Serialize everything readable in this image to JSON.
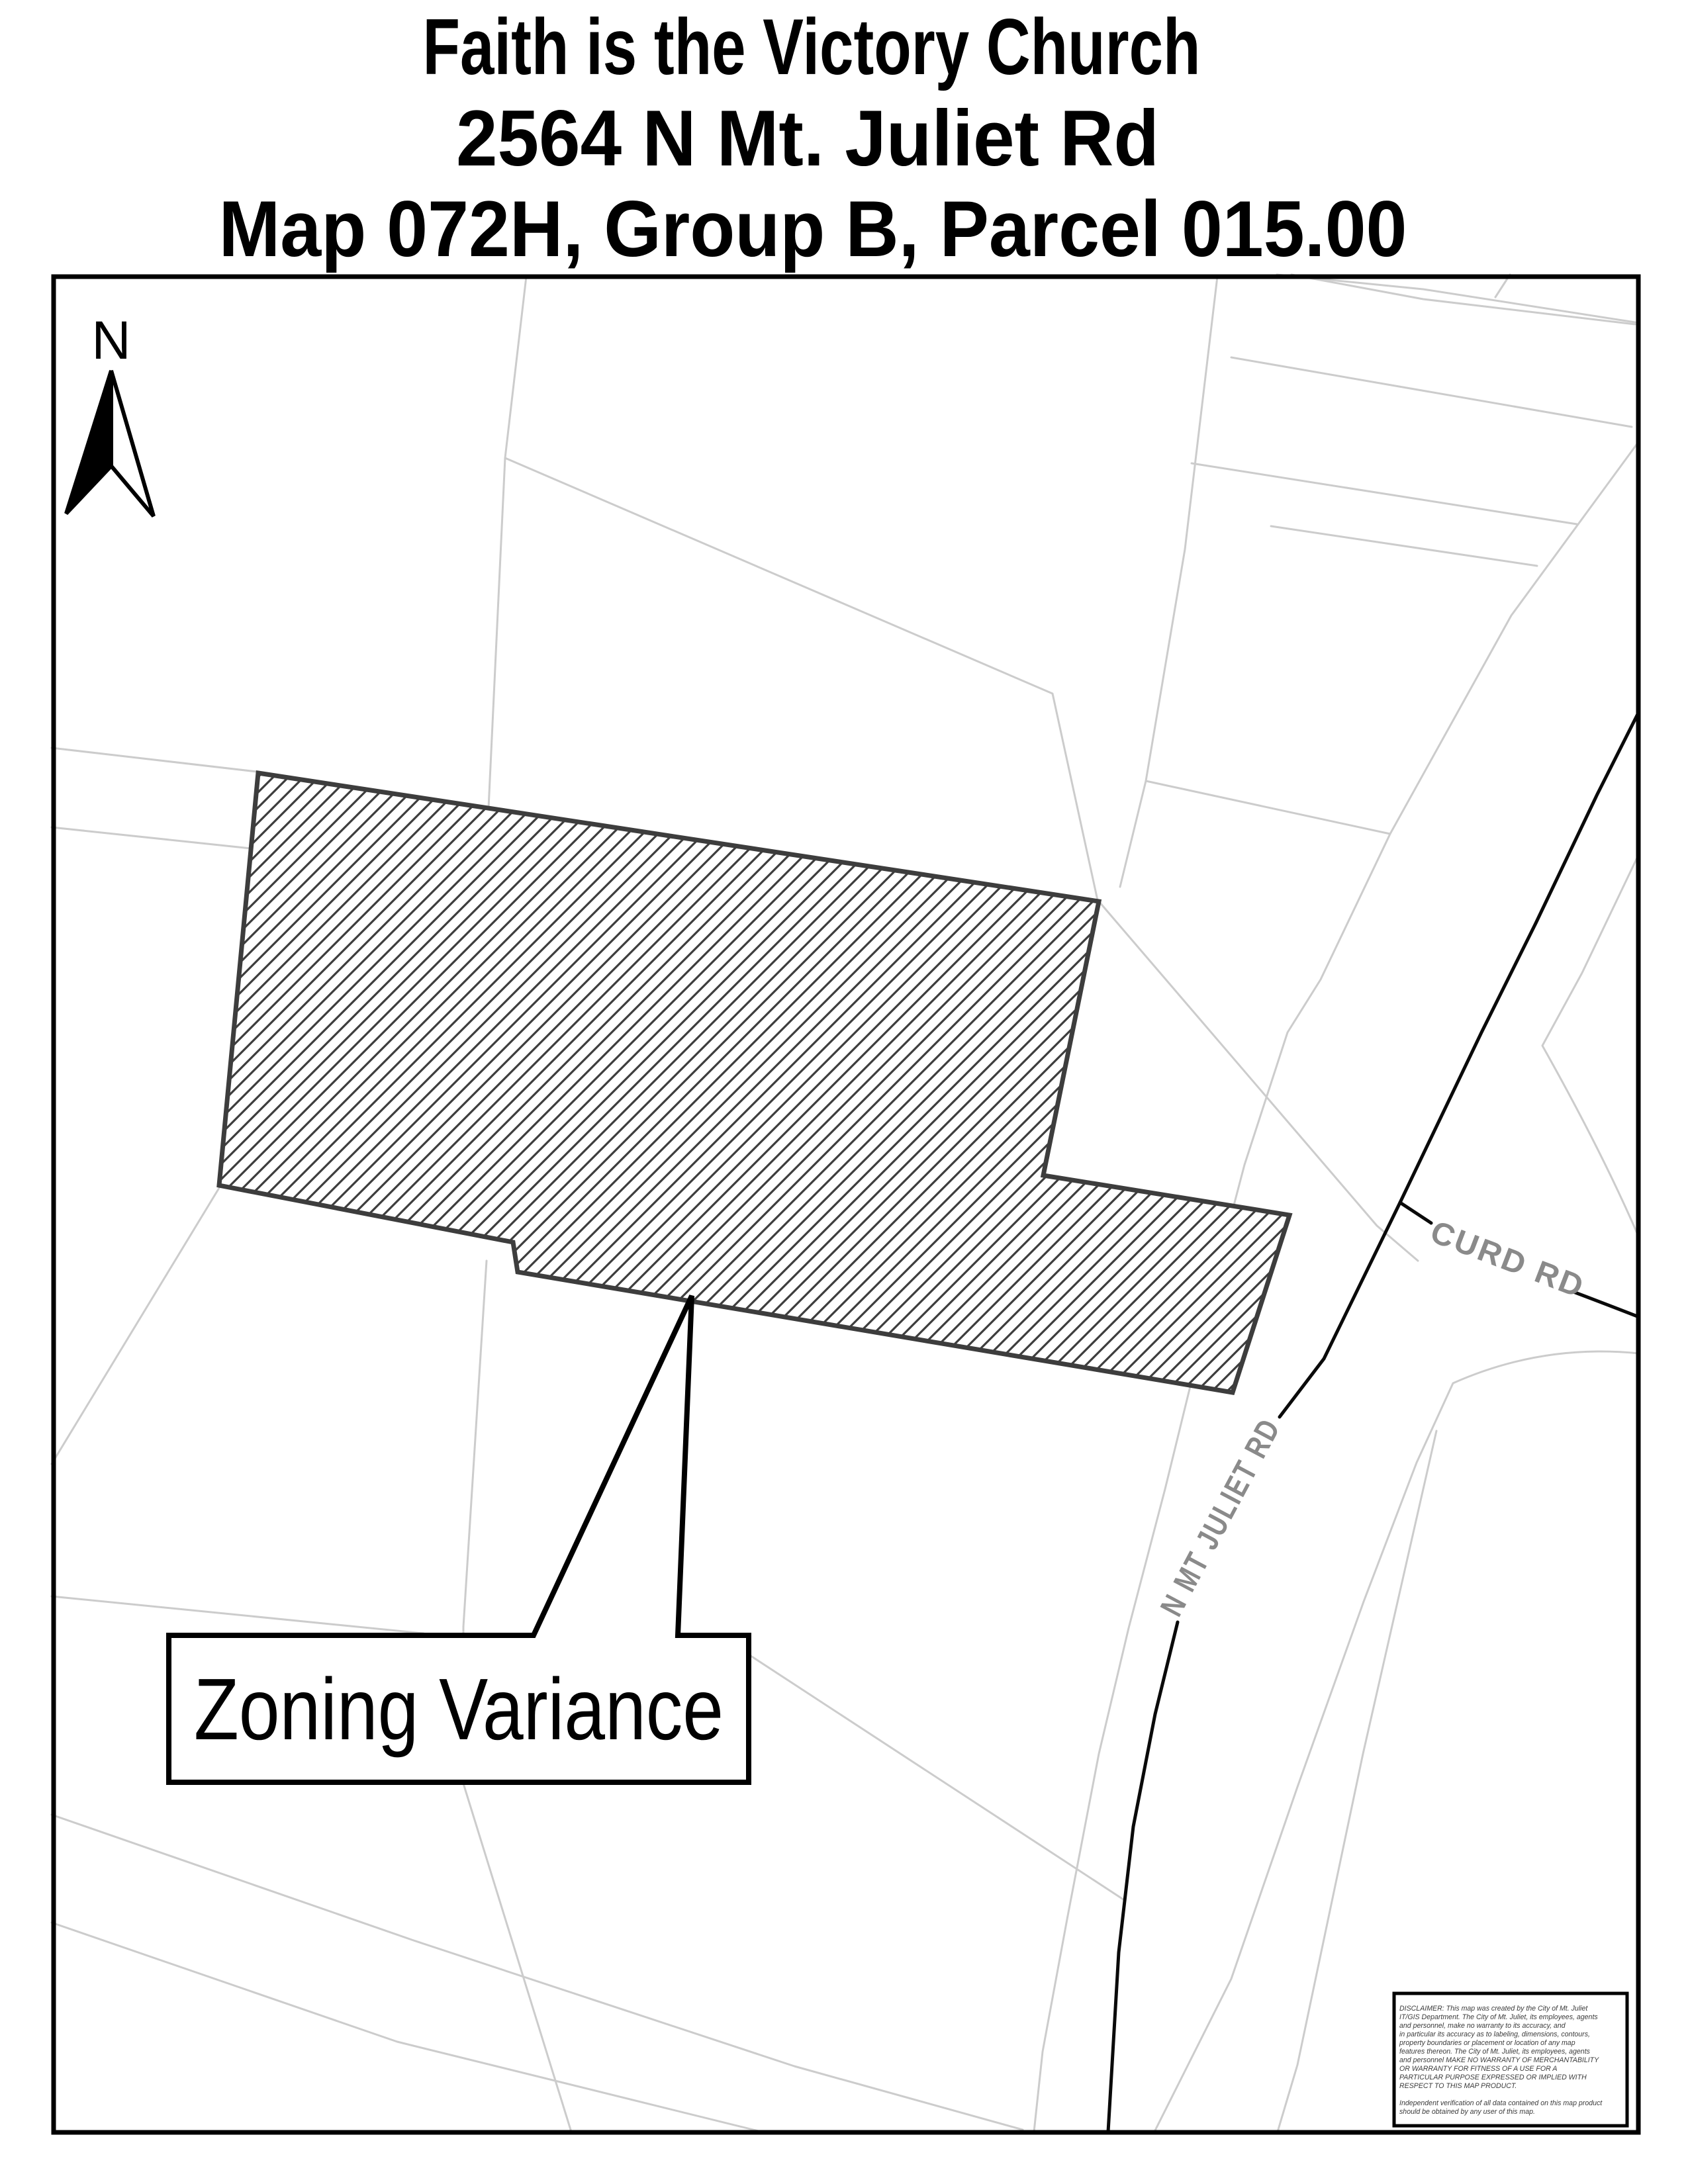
{
  "title": {
    "line1": "Faith is the Victory Church",
    "line2": "2564 N Mt. Juliet Rd",
    "line3": "Map 072H, Group B, Parcel 015.00"
  },
  "map": {
    "north_label": "N",
    "roads": {
      "curd": "CURD RD",
      "n_mt_juliet": "N MT JULIET RD"
    },
    "callout": {
      "label": "Zoning Variance"
    },
    "disclaimer": {
      "lines": [
        "DISCLAIMER: This map was created by the City of Mt. Juliet",
        "IT/GIS Department. The City of Mt. Juliet, its employees, agents",
        "and personnel, make no warranty to its accuracy, and",
        "in particular its accuracy as to labeling, dimensions, contours,",
        "property boundaries or placement or location of any map",
        "features thereon. The City of Mt. Juliet, its employees, agents",
        "and personnel MAKE NO WARRANTY OF MERCHANTABILITY",
        "OR WARRANTY FOR FITNESS OF A USE FOR A",
        "PARTICULAR PURPOSE EXPRESSED OR IMPLIED WITH",
        "RESPECT TO THIS MAP PRODUCT.",
        "",
        "Independent verification of all data contained on this map product",
        "should be obtained by any user of this map."
      ]
    },
    "colors": {
      "parcel_line": "#cccccc",
      "road_line": "#0a0a0a",
      "hatch_and_parcel_outline": "#3d3d3d",
      "road_label_gray": "#8a8a8a",
      "map_border": "#000000"
    }
  }
}
